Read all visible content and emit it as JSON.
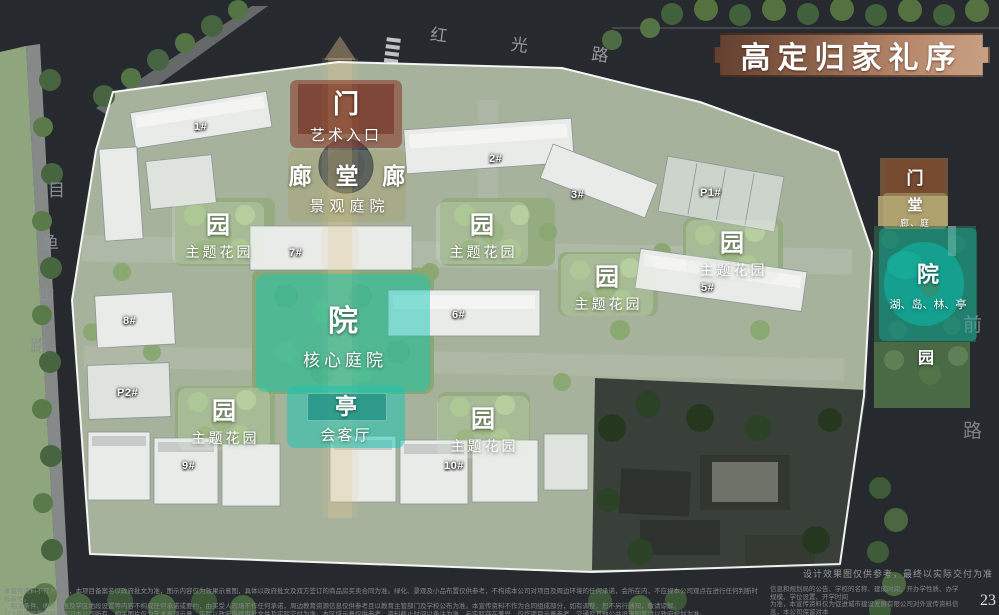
{
  "banner": {
    "title": "高定归家礼序"
  },
  "roads": {
    "top": "红 光 路",
    "left_chars": [
      "目",
      "鱼",
      "山",
      "路"
    ],
    "right_chars": [
      "前",
      "路"
    ]
  },
  "labels": {
    "gate": {
      "big": "门",
      "sub": "艺术入口"
    },
    "corridor": {
      "big": "廊 堂 廊",
      "sub": "景观庭院"
    },
    "garden": {
      "big": "园",
      "sub": "主题花园"
    },
    "core": {
      "big": "院",
      "sub": "核心庭院"
    },
    "pavilion": {
      "big": "亭",
      "sub": "会客厅"
    },
    "east_gate": {
      "big": "门"
    },
    "east_hall": {
      "big": "堂",
      "sub": "廊、庭"
    },
    "east_court": {
      "big": "院",
      "sub": "湖、岛、林、亭"
    },
    "east_garden": {
      "big": "园"
    }
  },
  "buildings": {
    "b1": "1#",
    "b2": "2#",
    "b3": "3#",
    "p1": "P1#",
    "b5": "5#",
    "b6": "6#",
    "b7": "7#",
    "b8": "8#",
    "p2": "P2#",
    "b9": "9#",
    "b10": "10#"
  },
  "colors": {
    "teal_overlay": "#16c7b4",
    "gate_overlay": "#88382a",
    "plaque_bronze": "#b98a6d",
    "boundary": "#ffffff"
  },
  "footer": {
    "note": "设计效果图仅供参考，最终以实际交付为准",
    "left_lines": [
      "本宣传资料不作为要约，本项目备案名以政府批文为准，图示内容仅为效果示意图，具体以政府批文及双方签订的商品房买卖合同为准。绿化、景观及小品布置仅供参考，不构成本公司对项目及周边环境的任何承诺，会所在内，不应视本公司观点在进行任何判断时作参考。",
      "、相关条件、收费标准及学区地段设置等内容不构成任何承诺或要约，由买受人现场不作任何承诺，周边教育资源信息仅供参考且以教育主管部门及学校公布为准。本宣传资料不作为合同组成部分，如有调整，恕不另行通知，敬请谅解。",
      "以上内容的最终解释权归本公司所有。相关图片仅为艺术表现示意，实际以政府最终审批文件及实际交付为准。本区域示意仅供参考，资料截止时间以备注为准，与实际存在差异，仅作项目示意参考，交通及其他公共设施配套请以政府规划为准。"
    ],
    "right_lines": [
      "信息和规划局的公告、学校的名称、建成时间、开办学性质、办学规模、学位设置、开学时间",
      "为准，本宣传资料仅为促进城市建设发展有限公司对外宣传资料信息，本公司保留对本",
      "宣传文件为准。以上资料为截止于2023年9月26日的情况。"
    ],
    "page": "23"
  }
}
